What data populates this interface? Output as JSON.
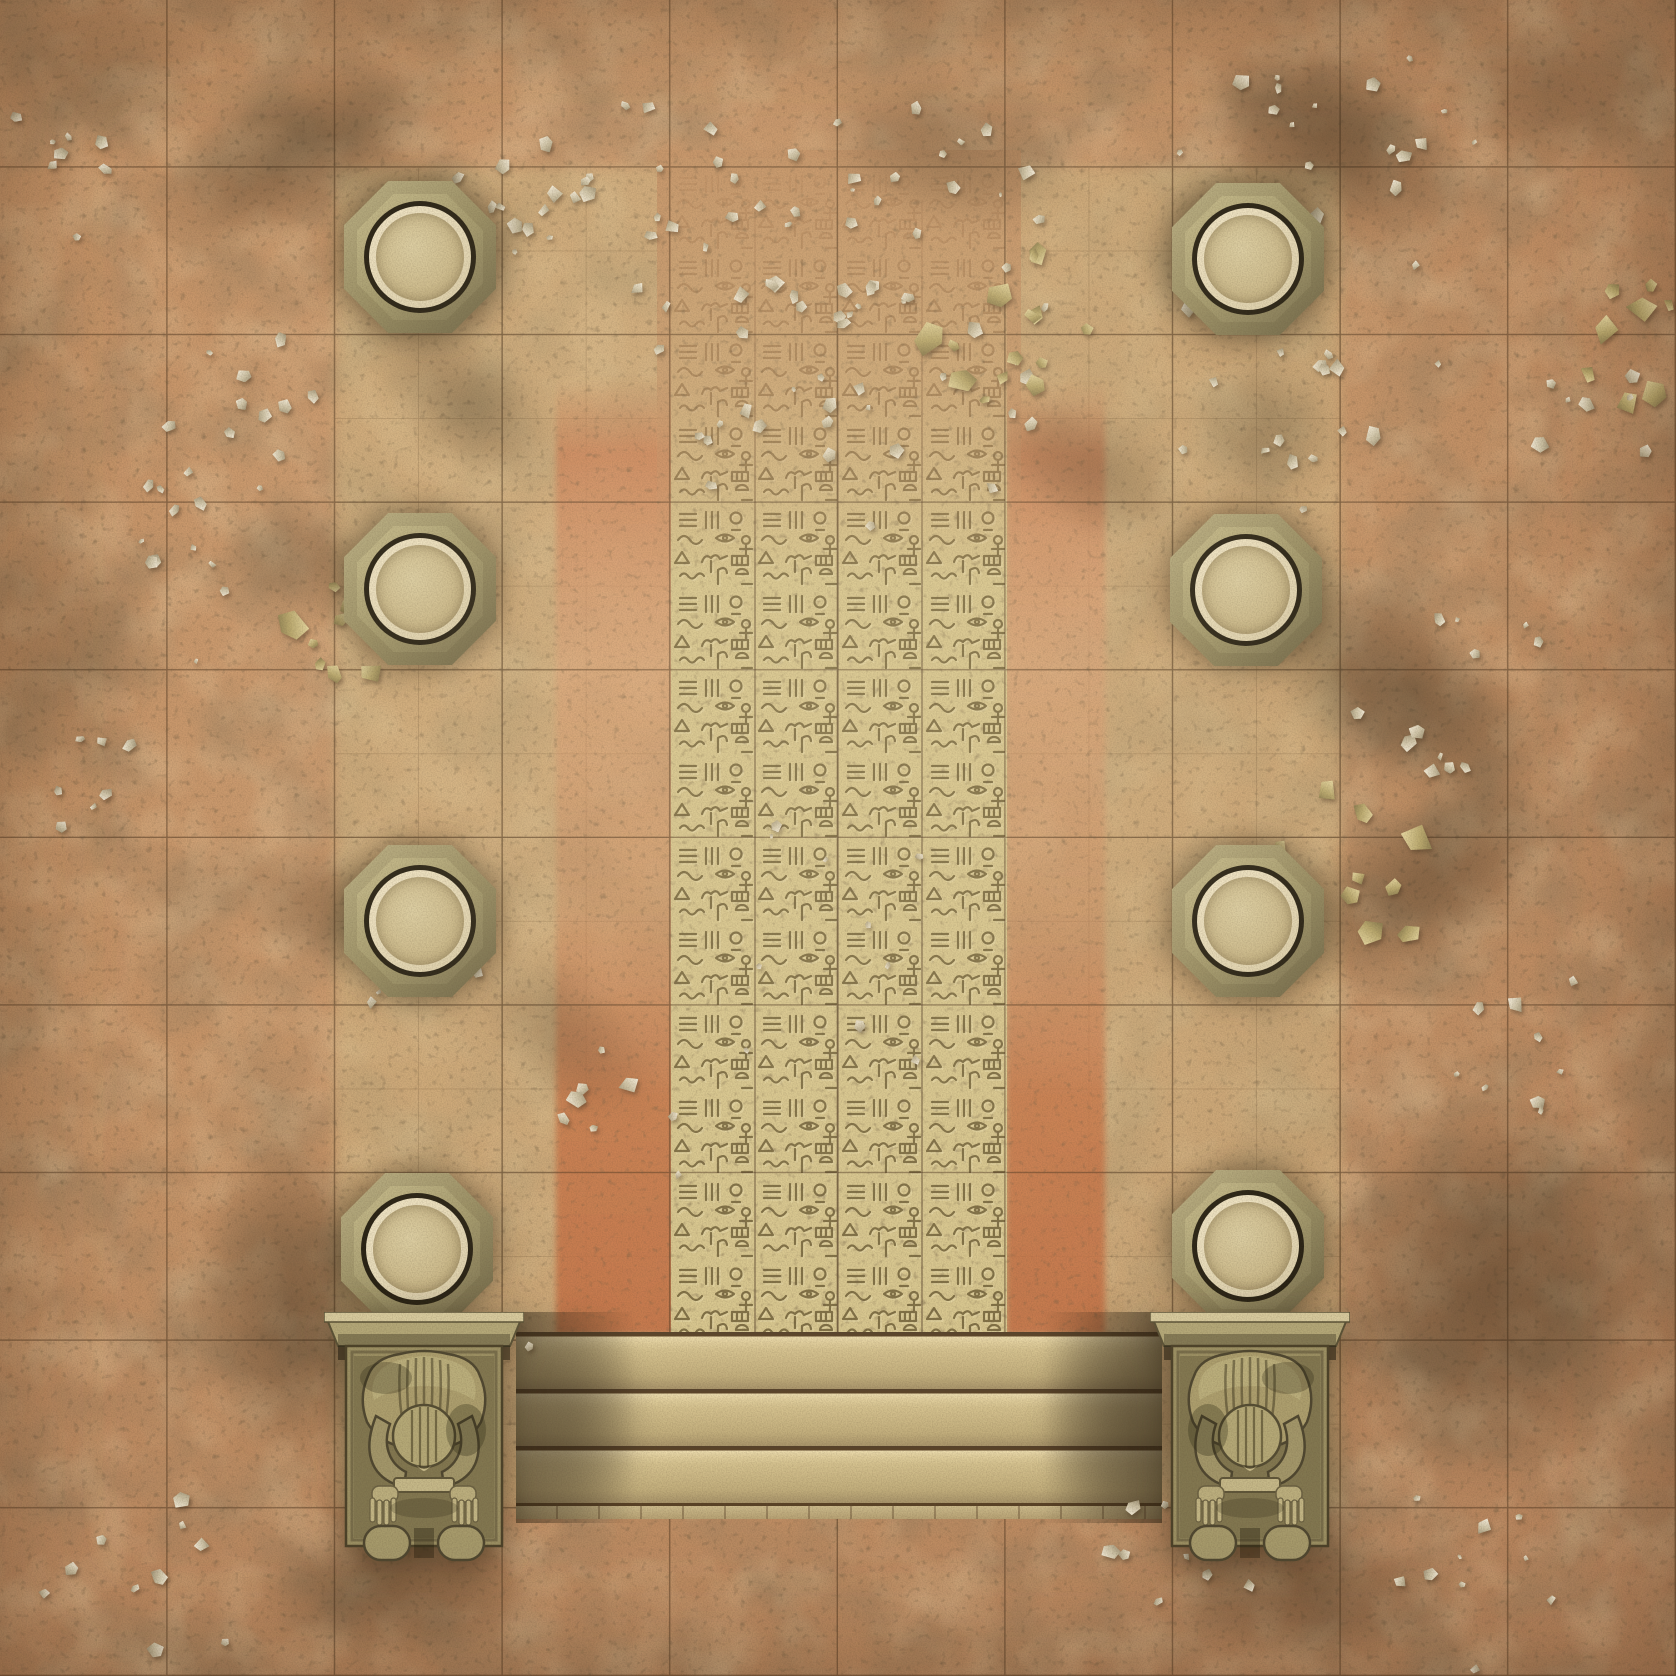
{
  "scene": {
    "description": "Top-down Egyptian temple courtyard battle mat: square grid over weathered sand, eight round column tops, central hieroglyph-carved processional path flanked by ochre tile strips, twin kneeling guardian statues and a broad staircase at the bottom",
    "size_px": 1676,
    "grid": {
      "columns": 10,
      "rows": 10,
      "cell_px": 167.6,
      "line_color": "#4a321c"
    },
    "palette": {
      "sand_base": "#c6956a",
      "sand_light": "#d8ac7e",
      "sand_dark": "#a87e58",
      "plaza_tile": "#d6c28c",
      "glyph_stone": "#d8c78f",
      "glyph_stroke": "#6d5d35",
      "ochre_tile": "#cd7f55",
      "ochre_deep": "#b4663f",
      "column_stone": "#9a8f64",
      "column_rim": "#ecdfbf",
      "column_cap": "#d3c296",
      "statue_stone": "#a89c6e",
      "step_face": "#d5c28f",
      "step_groove": "#5a4226",
      "shadow": "#2a2012",
      "debris_light": "#f4ecd9",
      "debris_gold": "#c9b97f"
    },
    "plaza": {
      "x": 335,
      "y": 168,
      "width": 1006,
      "height": 1340
    },
    "hieroglyph_path": {
      "x": 671,
      "y": 158,
      "width": 336,
      "height": 1174
    },
    "ochre_strips": [
      {
        "x": 556,
        "y": 378,
        "width": 118,
        "height": 956
      },
      {
        "x": 1007,
        "y": 378,
        "width": 98,
        "height": 956
      }
    ],
    "columns": [
      {
        "cx": 420,
        "cy": 257
      },
      {
        "cx": 420,
        "cy": 589
      },
      {
        "cx": 420,
        "cy": 921
      },
      {
        "cx": 417,
        "cy": 1249
      },
      {
        "cx": 1248,
        "cy": 259
      },
      {
        "cx": 1246,
        "cy": 590
      },
      {
        "cx": 1248,
        "cy": 921
      },
      {
        "cx": 1248,
        "cy": 1246
      }
    ],
    "statues": [
      {
        "cx": 424,
        "top": 1312,
        "flip": false
      },
      {
        "cx": 1250,
        "top": 1312,
        "flip": true
      }
    ],
    "steps": {
      "x": 516,
      "top": 1332,
      "width": 646,
      "count": 3,
      "step_h": 57,
      "base_h": 16
    },
    "shadows": [
      {
        "x": 300,
        "y": 150,
        "w": 320,
        "h": 150,
        "rot": -25,
        "o": 0.45
      },
      {
        "x": 95,
        "y": 70,
        "w": 240,
        "h": 150,
        "rot": 0,
        "o": 0.22
      },
      {
        "x": 470,
        "y": 405,
        "w": 210,
        "h": 115,
        "rot": 38,
        "o": 0.33
      },
      {
        "x": 300,
        "y": 560,
        "w": 160,
        "h": 110,
        "rot": 10,
        "o": 0.28
      },
      {
        "x": 318,
        "y": 905,
        "w": 170,
        "h": 120,
        "rot": 15,
        "o": 0.28
      },
      {
        "x": 560,
        "y": 1035,
        "w": 230,
        "h": 120,
        "rot": 42,
        "o": 0.22
      },
      {
        "x": 290,
        "y": 1300,
        "w": 190,
        "h": 340,
        "rot": 0,
        "o": 0.45
      },
      {
        "x": 400,
        "y": 1590,
        "w": 290,
        "h": 140,
        "rot": 0,
        "o": 0.4
      },
      {
        "x": 1330,
        "y": 140,
        "w": 290,
        "h": 170,
        "rot": 30,
        "o": 0.5
      },
      {
        "x": 1560,
        "y": 95,
        "w": 260,
        "h": 160,
        "rot": 0,
        "o": 0.3
      },
      {
        "x": 1262,
        "y": 432,
        "w": 150,
        "h": 150,
        "rot": 0,
        "o": 0.26
      },
      {
        "x": 1400,
        "y": 690,
        "w": 340,
        "h": 175,
        "rot": 38,
        "o": 0.5
      },
      {
        "x": 1425,
        "y": 880,
        "w": 310,
        "h": 160,
        "rot": -32,
        "o": 0.45
      },
      {
        "x": 1495,
        "y": 1290,
        "w": 340,
        "h": 400,
        "rot": 12,
        "o": 0.5
      },
      {
        "x": 1305,
        "y": 1595,
        "w": 300,
        "h": 140,
        "rot": 0,
        "o": 0.4
      },
      {
        "x": 575,
        "y": 1415,
        "w": 150,
        "h": 230,
        "rot": 0,
        "o": 0.38
      },
      {
        "x": 1118,
        "y": 1415,
        "w": 165,
        "h": 230,
        "rot": 0,
        "o": 0.42
      },
      {
        "x": 950,
        "y": 150,
        "w": 270,
        "h": 150,
        "rot": 12,
        "o": 0.3
      },
      {
        "x": 1092,
        "y": 470,
        "w": 210,
        "h": 125,
        "rot": 30,
        "o": 0.28
      },
      {
        "x": 60,
        "y": 650,
        "w": 180,
        "h": 290,
        "rot": 0,
        "o": 0.2
      },
      {
        "x": 430,
        "y": 262,
        "w": 200,
        "h": 200,
        "rot": 0,
        "o": 0.3
      },
      {
        "x": 1240,
        "y": 262,
        "w": 200,
        "h": 200,
        "rot": 0,
        "o": 0.3
      }
    ],
    "debris_clusters": [
      {
        "cx": 850,
        "cy": 300,
        "r": 250,
        "n": 60,
        "kind": "flake"
      },
      {
        "cx": 995,
        "cy": 330,
        "r": 95,
        "n": 14,
        "kind": "gold"
      },
      {
        "cx": 700,
        "cy": 200,
        "r": 120,
        "n": 14,
        "kind": "flake"
      },
      {
        "cx": 520,
        "cy": 210,
        "r": 110,
        "n": 14,
        "kind": "flake"
      },
      {
        "cx": 255,
        "cy": 420,
        "r": 95,
        "n": 10,
        "kind": "flake"
      },
      {
        "cx": 185,
        "cy": 580,
        "r": 120,
        "n": 13,
        "kind": "flake"
      },
      {
        "cx": 335,
        "cy": 655,
        "r": 80,
        "n": 9,
        "kind": "gold"
      },
      {
        "cx": 95,
        "cy": 800,
        "r": 70,
        "n": 7,
        "kind": "flake"
      },
      {
        "cx": 60,
        "cy": 170,
        "r": 80,
        "n": 8,
        "kind": "flake"
      },
      {
        "cx": 1300,
        "cy": 360,
        "r": 150,
        "n": 20,
        "kind": "flake"
      },
      {
        "cx": 1245,
        "cy": 150,
        "r": 85,
        "n": 8,
        "kind": "flake"
      },
      {
        "cx": 1445,
        "cy": 120,
        "r": 85,
        "n": 8,
        "kind": "flake"
      },
      {
        "cx": 1620,
        "cy": 330,
        "r": 80,
        "n": 8,
        "kind": "gold"
      },
      {
        "cx": 1460,
        "cy": 700,
        "r": 110,
        "n": 12,
        "kind": "flake"
      },
      {
        "cx": 1355,
        "cy": 880,
        "r": 95,
        "n": 10,
        "kind": "gold"
      },
      {
        "cx": 1530,
        "cy": 1040,
        "r": 85,
        "n": 9,
        "kind": "flake"
      },
      {
        "cx": 820,
        "cy": 940,
        "r": 160,
        "n": 10,
        "kind": "flake"
      },
      {
        "cx": 640,
        "cy": 1120,
        "r": 85,
        "n": 8,
        "kind": "flake"
      },
      {
        "cx": 480,
        "cy": 1350,
        "r": 65,
        "n": 7,
        "kind": "flake"
      },
      {
        "cx": 145,
        "cy": 1600,
        "r": 110,
        "n": 10,
        "kind": "flake"
      },
      {
        "cx": 1185,
        "cy": 1570,
        "r": 90,
        "n": 8,
        "kind": "flake"
      },
      {
        "cx": 1455,
        "cy": 1600,
        "r": 110,
        "n": 10,
        "kind": "flake"
      },
      {
        "cx": 1600,
        "cy": 430,
        "r": 70,
        "n": 7,
        "kind": "flake"
      },
      {
        "cx": 420,
        "cy": 1000,
        "r": 70,
        "n": 6,
        "kind": "flake"
      }
    ]
  }
}
